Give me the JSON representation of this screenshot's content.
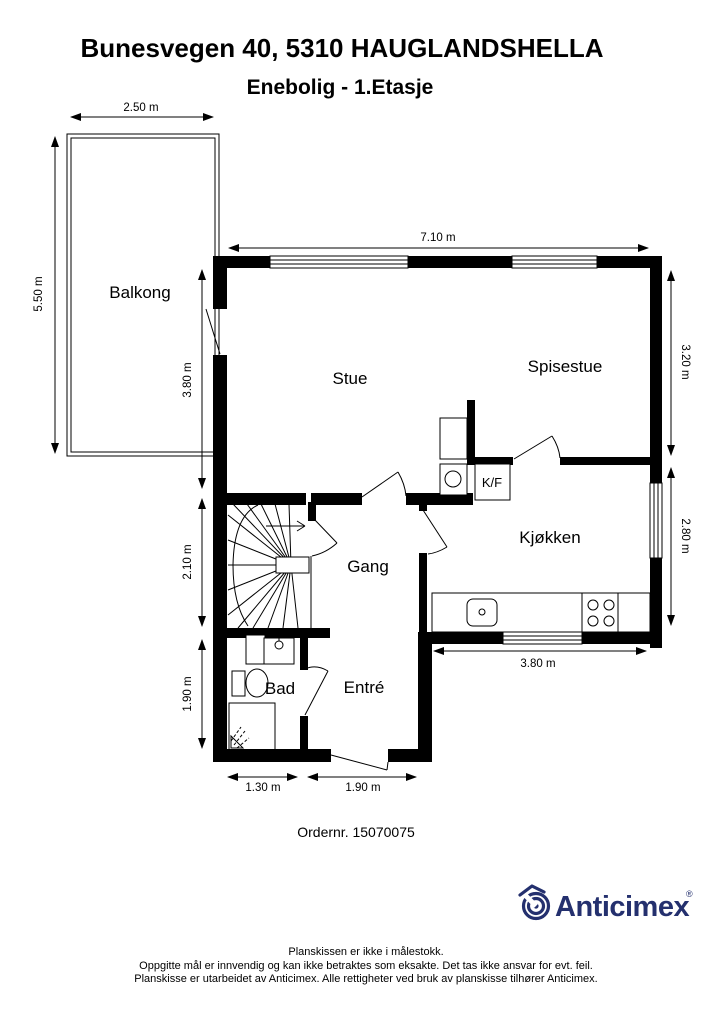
{
  "page": {
    "title": "Bunesvegen 40, 5310 HAUGLANDSHELLA",
    "subtitle": "Enebolig - 1.Etasje",
    "order_number": "Ordernr. 15070075"
  },
  "plan": {
    "rooms": {
      "balkong": "Balkong",
      "stue": "Stue",
      "spisestue": "Spisestue",
      "kjokken": "Kjøkken",
      "gang": "Gang",
      "bad": "Bad",
      "entre": "Entré",
      "kf": "K/F"
    },
    "dimensions": {
      "balkong_width": "2.50 m",
      "balkong_depth": "5.50 m",
      "top_width": "7.10 m",
      "stue_left": "3.80 m",
      "spisestue_right": "3.20 m",
      "kjokken_right": "2.80 m",
      "gang_left": "2.10 m",
      "bad_left": "1.90 m",
      "kjokken_bottom": "3.80 m",
      "bad_bottom": "1.30 m",
      "entre_bottom": "1.90 m"
    },
    "colors": {
      "walls": "#000000",
      "background": "#ffffff"
    }
  },
  "branding": {
    "logo_text": "Anticimex",
    "registered_mark": "®",
    "logo_color": "#24306e"
  },
  "footer": {
    "line1": "Planskissen er ikke i målestokk.",
    "line2": "Oppgitte mål er innvendig og kan ikke betraktes som eksakte. Det tas ikke ansvar for evt. feil.",
    "line3": "Planskisse er utarbeidet av Anticimex. Alle rettigheter ved bruk av planskisse tilhører Anticimex."
  }
}
